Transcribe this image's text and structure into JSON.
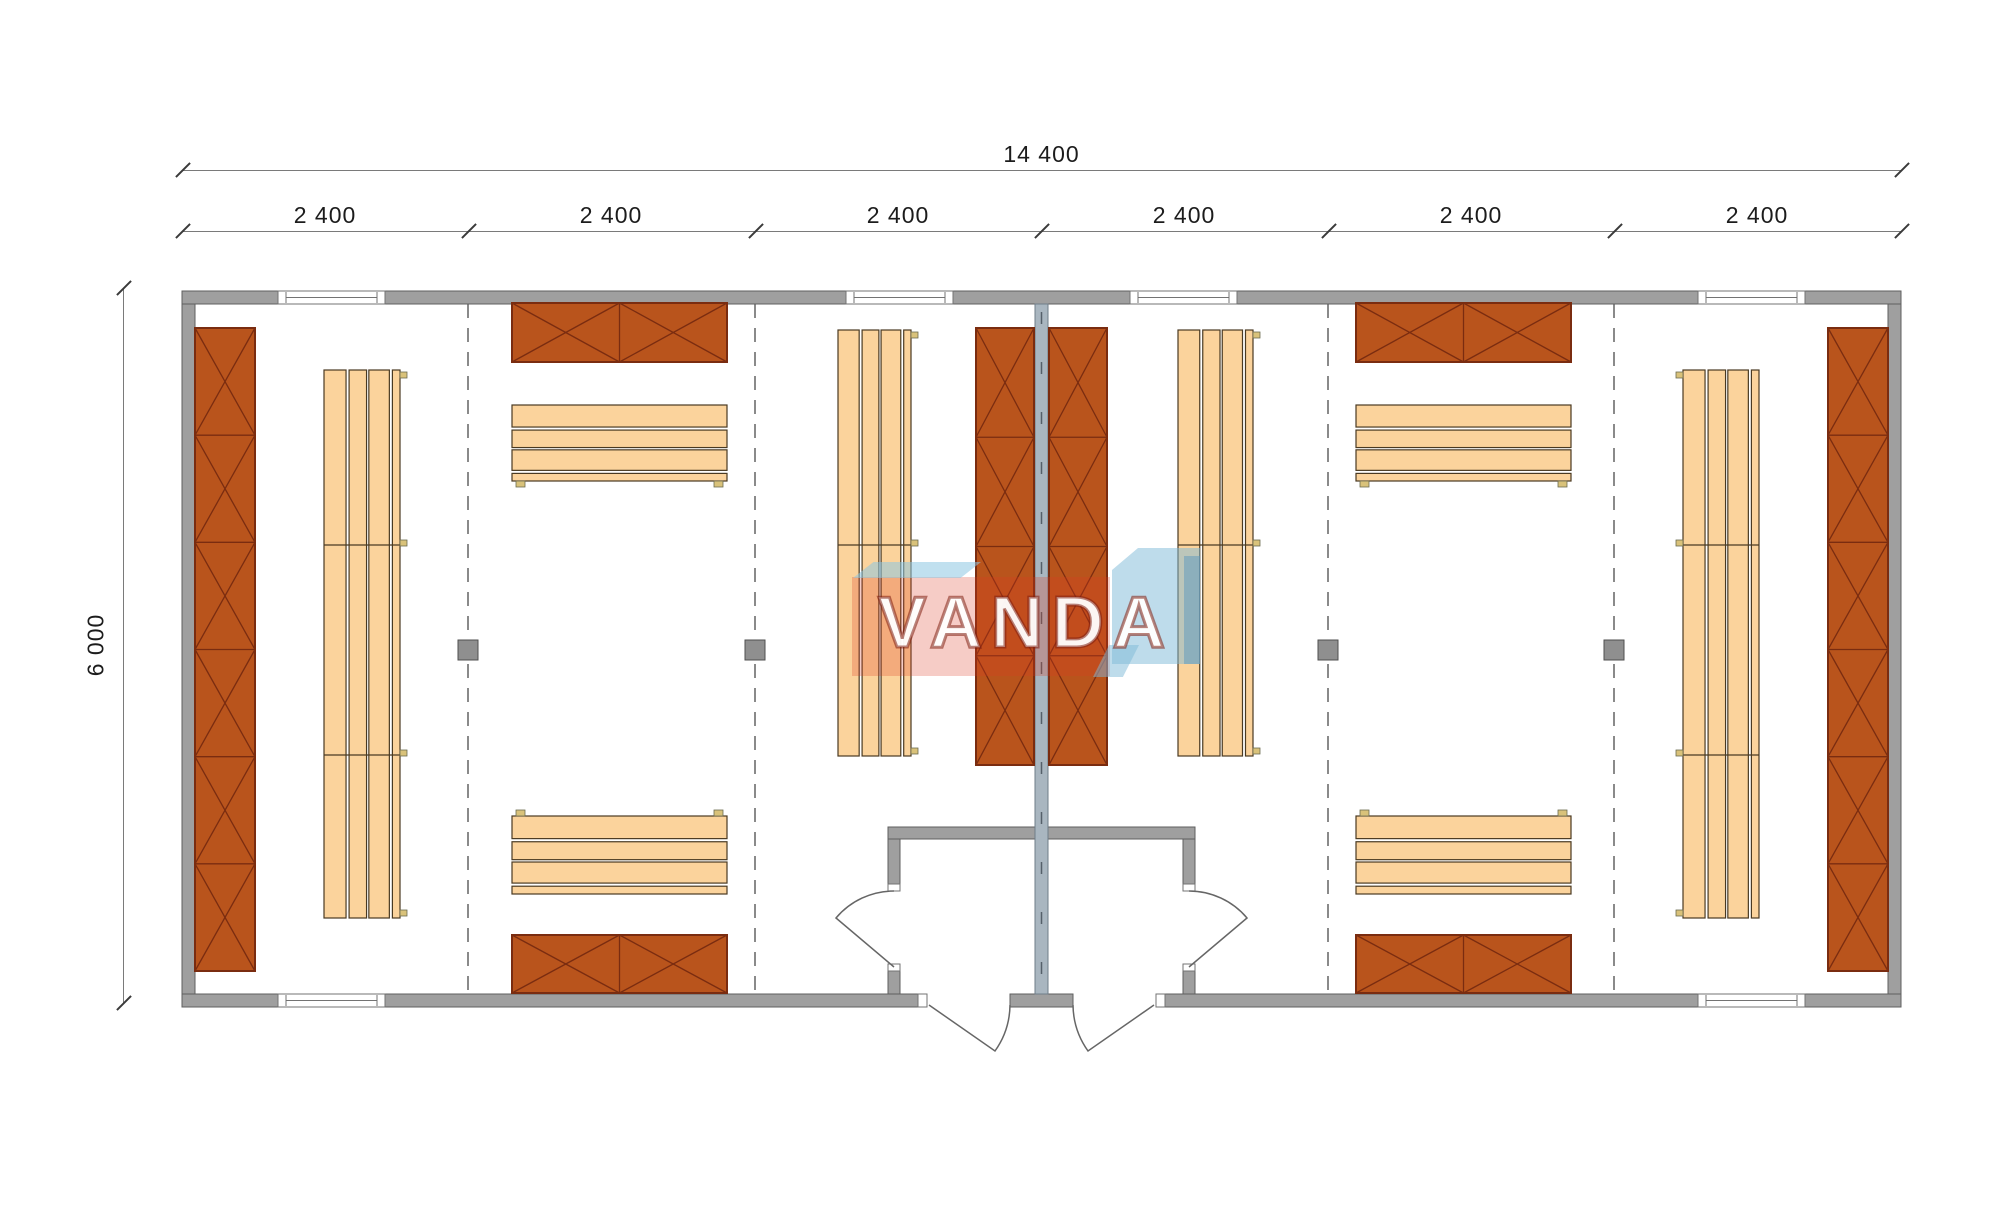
{
  "canvas": {
    "width": 2000,
    "height": 1226,
    "background": "#ffffff"
  },
  "dimensions": {
    "overall_width_label": "14 400",
    "segment_labels": [
      "2 400",
      "2 400",
      "2 400",
      "2 400",
      "2 400",
      "2 400"
    ],
    "overall_height_label": "6 000"
  },
  "watermark": {
    "text": "VANDA"
  },
  "colors": {
    "wall_fill": "#9f9f9f",
    "wall_edge": "#5f5f5f",
    "partition_fill": "#a9b6c0",
    "partition_edge": "#6f7d88",
    "partition_dash": "#55606a",
    "rack_fill": "#b9541c",
    "rack_line": "#7a2c10",
    "bench_fill": "#fbd39c",
    "bench_line": "#4a3a22",
    "tab_fill": "#d9c27a",
    "tab_edge": "#6b6b50",
    "window_line": "#737373",
    "door_line": "#666666",
    "post_fill": "#8f8f8f",
    "post_edge": "#4f4f4f",
    "module_dash": "#8a8a8a",
    "dimension_line": "#7a7a7a",
    "dimension_text": "#1c1c1c"
  },
  "plan": {
    "walls": [
      {
        "x": 182,
        "y": 291,
        "w": 1719,
        "h": 13
      },
      {
        "x": 182,
        "y": 994,
        "w": 736,
        "h": 13
      },
      {
        "x": 1010,
        "y": 994,
        "w": 63,
        "h": 13
      },
      {
        "x": 1165,
        "y": 994,
        "w": 736,
        "h": 13
      },
      {
        "x": 182,
        "y": 304,
        "w": 13,
        "h": 690
      },
      {
        "x": 1888,
        "y": 304,
        "w": 13,
        "h": 690
      },
      {
        "x": 888,
        "y": 827,
        "w": 307,
        "h": 12
      },
      {
        "x": 888,
        "y": 839,
        "w": 12,
        "h": 45
      },
      {
        "x": 888,
        "y": 971,
        "w": 12,
        "h": 23
      },
      {
        "x": 1183,
        "y": 839,
        "w": 12,
        "h": 45
      },
      {
        "x": 1183,
        "y": 971,
        "w": 12,
        "h": 23
      }
    ],
    "partition": {
      "x": 1035,
      "y": 304,
      "w": 13,
      "h": 690
    },
    "jambs": [
      {
        "x": 888,
        "y": 884,
        "w": 12,
        "h": 7
      },
      {
        "x": 888,
        "y": 964,
        "w": 12,
        "h": 7
      },
      {
        "x": 1183,
        "y": 884,
        "w": 12,
        "h": 7
      },
      {
        "x": 1183,
        "y": 964,
        "w": 12,
        "h": 7
      },
      {
        "x": 918,
        "y": 994,
        "w": 9,
        "h": 13
      },
      {
        "x": 1156,
        "y": 994,
        "w": 9,
        "h": 13
      }
    ],
    "windows": [
      {
        "x": 278,
        "y": 291,
        "w": 107,
        "h": 13
      },
      {
        "x": 846,
        "y": 291,
        "w": 107,
        "h": 13
      },
      {
        "x": 1130,
        "y": 291,
        "w": 107,
        "h": 13
      },
      {
        "x": 1698,
        "y": 291,
        "w": 107,
        "h": 13
      },
      {
        "x": 278,
        "y": 994,
        "w": 107,
        "h": 13
      },
      {
        "x": 1698,
        "y": 994,
        "w": 107,
        "h": 13
      }
    ],
    "module_lines": [
      467,
      754,
      1327,
      1613
    ],
    "module_line_span": {
      "y1": 304,
      "y2": 994
    },
    "posts": [
      {
        "x": 458,
        "y": 640,
        "w": 20,
        "h": 20
      },
      {
        "x": 745,
        "y": 640,
        "w": 20,
        "h": 20
      },
      {
        "x": 1318,
        "y": 640,
        "w": 20,
        "h": 20
      },
      {
        "x": 1604,
        "y": 640,
        "w": 20,
        "h": 20
      }
    ],
    "racks": [
      {
        "x": 195,
        "y": 328,
        "w": 60,
        "h": 643,
        "o": "v",
        "n": 6
      },
      {
        "x": 1828,
        "y": 328,
        "w": 60,
        "h": 643,
        "o": "v",
        "n": 6
      },
      {
        "x": 976,
        "y": 328,
        "w": 58,
        "h": 437,
        "o": "v",
        "n": 4
      },
      {
        "x": 1049,
        "y": 328,
        "w": 58,
        "h": 437,
        "o": "v",
        "n": 4
      },
      {
        "x": 512,
        "y": 303,
        "w": 215,
        "h": 59,
        "o": "h",
        "n": 2
      },
      {
        "x": 1356,
        "y": 303,
        "w": 215,
        "h": 59,
        "o": "h",
        "n": 2
      },
      {
        "x": 512,
        "y": 935,
        "w": 215,
        "h": 58,
        "o": "h",
        "n": 2
      },
      {
        "x": 1356,
        "y": 935,
        "w": 215,
        "h": 58,
        "o": "h",
        "n": 2
      }
    ],
    "benches": [
      {
        "x": 324,
        "y": 370,
        "w": 76,
        "h": 548,
        "o": "v",
        "joints": [
          545,
          755
        ],
        "tabSide": "right"
      },
      {
        "x": 1683,
        "y": 370,
        "w": 76,
        "h": 548,
        "o": "v",
        "joints": [
          545,
          755
        ],
        "tabSide": "left"
      },
      {
        "x": 838,
        "y": 330,
        "w": 73,
        "h": 426,
        "o": "v",
        "joints": [
          545
        ],
        "tabSide": "right"
      },
      {
        "x": 1178,
        "y": 330,
        "w": 75,
        "h": 426,
        "o": "v",
        "joints": [
          545
        ],
        "tabSide": "right"
      },
      {
        "x": 512,
        "y": 405,
        "w": 215,
        "h": 76,
        "o": "h",
        "joints": [],
        "tabSide": "bottom"
      },
      {
        "x": 1356,
        "y": 405,
        "w": 215,
        "h": 76,
        "o": "h",
        "joints": [],
        "tabSide": "bottom"
      },
      {
        "x": 512,
        "y": 816,
        "w": 215,
        "h": 78,
        "o": "h",
        "joints": [],
        "tabSide": "top"
      },
      {
        "x": 1356,
        "y": 816,
        "w": 215,
        "h": 78,
        "o": "h",
        "joints": [],
        "tabSide": "top"
      }
    ],
    "doors": [
      "M 929 1005 L 995 1051 A 81 81 0 0 0 1010 1005",
      "M 1154 1005 L 1088 1051 A 81 81 0 0 1 1073 1005",
      "M 894 967 L 836 918 A 76 76 0 0 1 894 891",
      "M 1189 967 L 1247 918 A 76 76 0 0 0 1189 891"
    ]
  }
}
